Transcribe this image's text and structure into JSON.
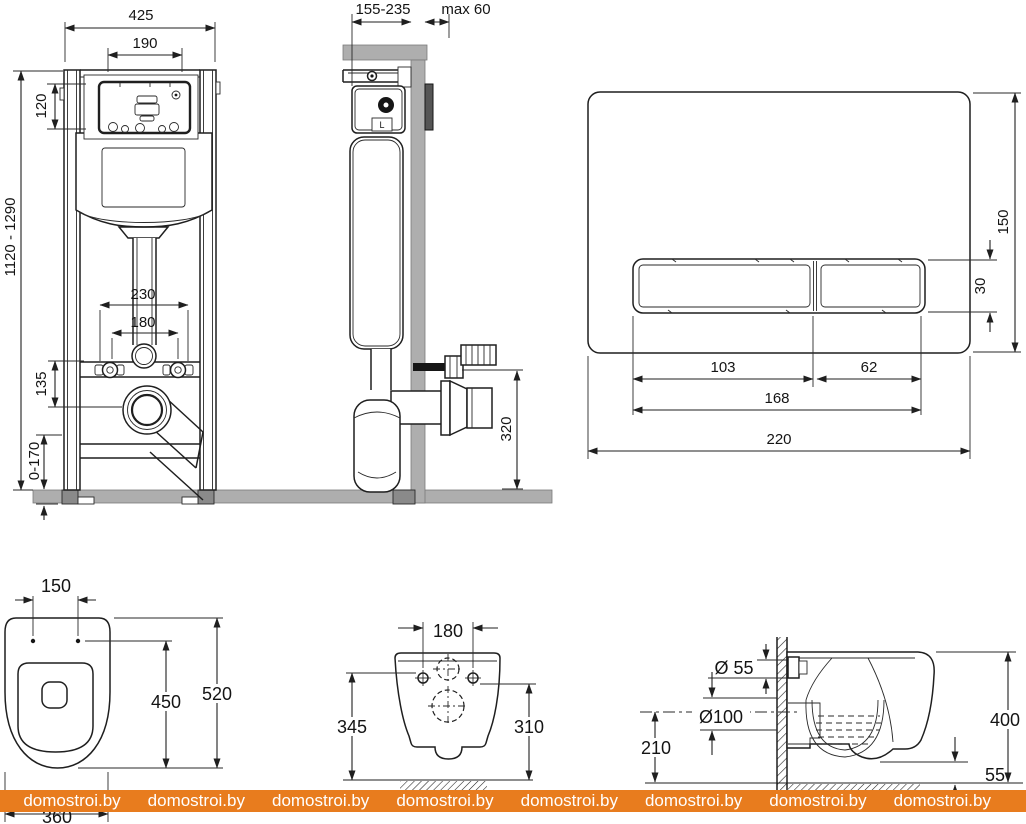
{
  "watermark": {
    "text": "domostroi.by",
    "band_color": "#e87c1e",
    "text_color": "#ffffff"
  },
  "frame_front": {
    "total_width": "425",
    "opening_width": "190",
    "opening_height": "120",
    "height_range": "1120 - 1290",
    "anchor_span": "230",
    "bolt_span": "180",
    "outlet_offset": "135",
    "leg_adjust": "0-170"
  },
  "frame_side": {
    "depth_range": "155-235",
    "wall_thickness": "max 60",
    "outlet_height": "320",
    "valve_mark": "L"
  },
  "flush_plate": {
    "height": "150",
    "button_height": "30",
    "big_button_width": "103",
    "small_button_width": "62",
    "buttons_width": "168",
    "width": "220"
  },
  "bowl_top": {
    "hole_span": "150",
    "bowl_length": "450",
    "total_length": "520",
    "width": "360"
  },
  "bowl_rear": {
    "hole_span": "180",
    "left_height": "345",
    "right_height": "310"
  },
  "bowl_side": {
    "inlet_dia": "Ø 55",
    "outlet_dia": "Ø100",
    "outlet_center_height": "210",
    "height": "400",
    "rim_clearance": "55"
  }
}
